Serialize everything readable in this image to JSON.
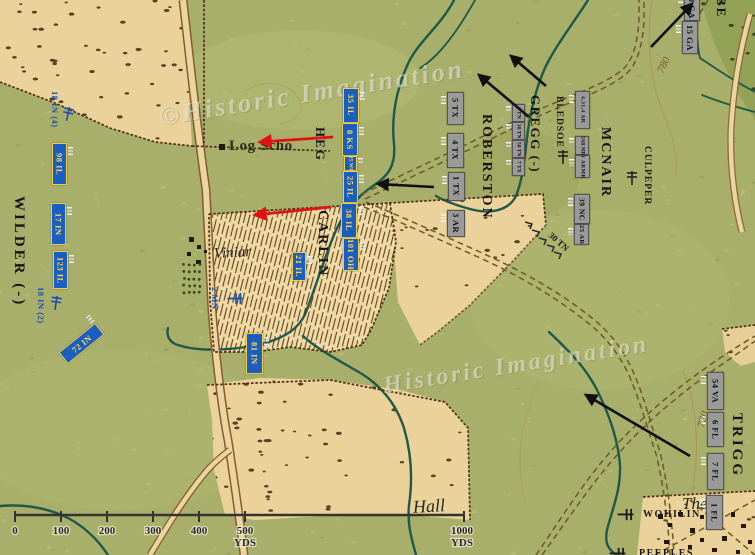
{
  "watermarks": {
    "top": "©Historic Imagination",
    "bottom": "Historic Imagination"
  },
  "places": {
    "log_school": "Log Scho",
    "viniard": "Viniar",
    "hall": "Hall",
    "thedford": "Thed",
    "wohilin": "WOHILIN",
    "bottom_partial": "PEEPLES",
    "contour_780": "780",
    "contour_720": "720"
  },
  "commanders": {
    "wilder": "WILDER (-)",
    "heg": "HEG",
    "carlin": "CARLIN",
    "robertson": "ROBERSTON",
    "gregg": "GREGG (-)",
    "bledsoe": "BLEDSOE",
    "mcnair": "MCNAIR",
    "culpeper": "CULPEPER",
    "trigg": "TRIGG",
    "benning_partial": "BE"
  },
  "union_units": {
    "u98il": "98 IL",
    "u17in": "17 IN",
    "u123il": "123 IL",
    "u72in": "72 IN",
    "u35il": "35 IL",
    "u8ks": "8 KS",
    "u15wi": "15 WI",
    "u25il": "25 IL",
    "u38il": "38 IL",
    "u101oh": "101 OH",
    "u21il": "21 IL",
    "u81in": "81 IN",
    "f18in4": "18 IN (4)",
    "f18in2": "18 IN (2)",
    "f2mn": "2 MN"
  },
  "confederate_units": {
    "u5tx": "5 TX",
    "u4tx": "4 TX",
    "u1tx": "1 TX",
    "u3ar": "3 AR",
    "g1tn": "1 TN",
    "g10tn": "10 TN",
    "g50tn": "50 TN",
    "g7tx": "7 TX",
    "m4314ar": "4,31,4 AR",
    "m2armr": "2AR MR",
    "m1armr": "1 ARMR",
    "m39nc": "39 NC",
    "m25ar": "25 AR",
    "b15ga": "15 GA",
    "b20ga": "20 GA",
    "t54va": "54 VA",
    "t6fl": "6 FL",
    "t7fl": "7 FL",
    "t1fl": "1 FL",
    "skirmish": "30 TN"
  },
  "scale": {
    "t0": "0",
    "t100": "100",
    "t200": "200",
    "t300": "300",
    "t400": "400",
    "t500": "500",
    "unit_500": "YDS",
    "t1000": "1000",
    "unit_1000": "YDS"
  },
  "colors": {
    "union_blue": "#1b5ec2",
    "confederate_gray": "#9a9a9a",
    "arrow_red": "#e31212",
    "arrow_black": "#101010",
    "stream_teal": "#20584a",
    "field_tan": "#ebd29b"
  }
}
